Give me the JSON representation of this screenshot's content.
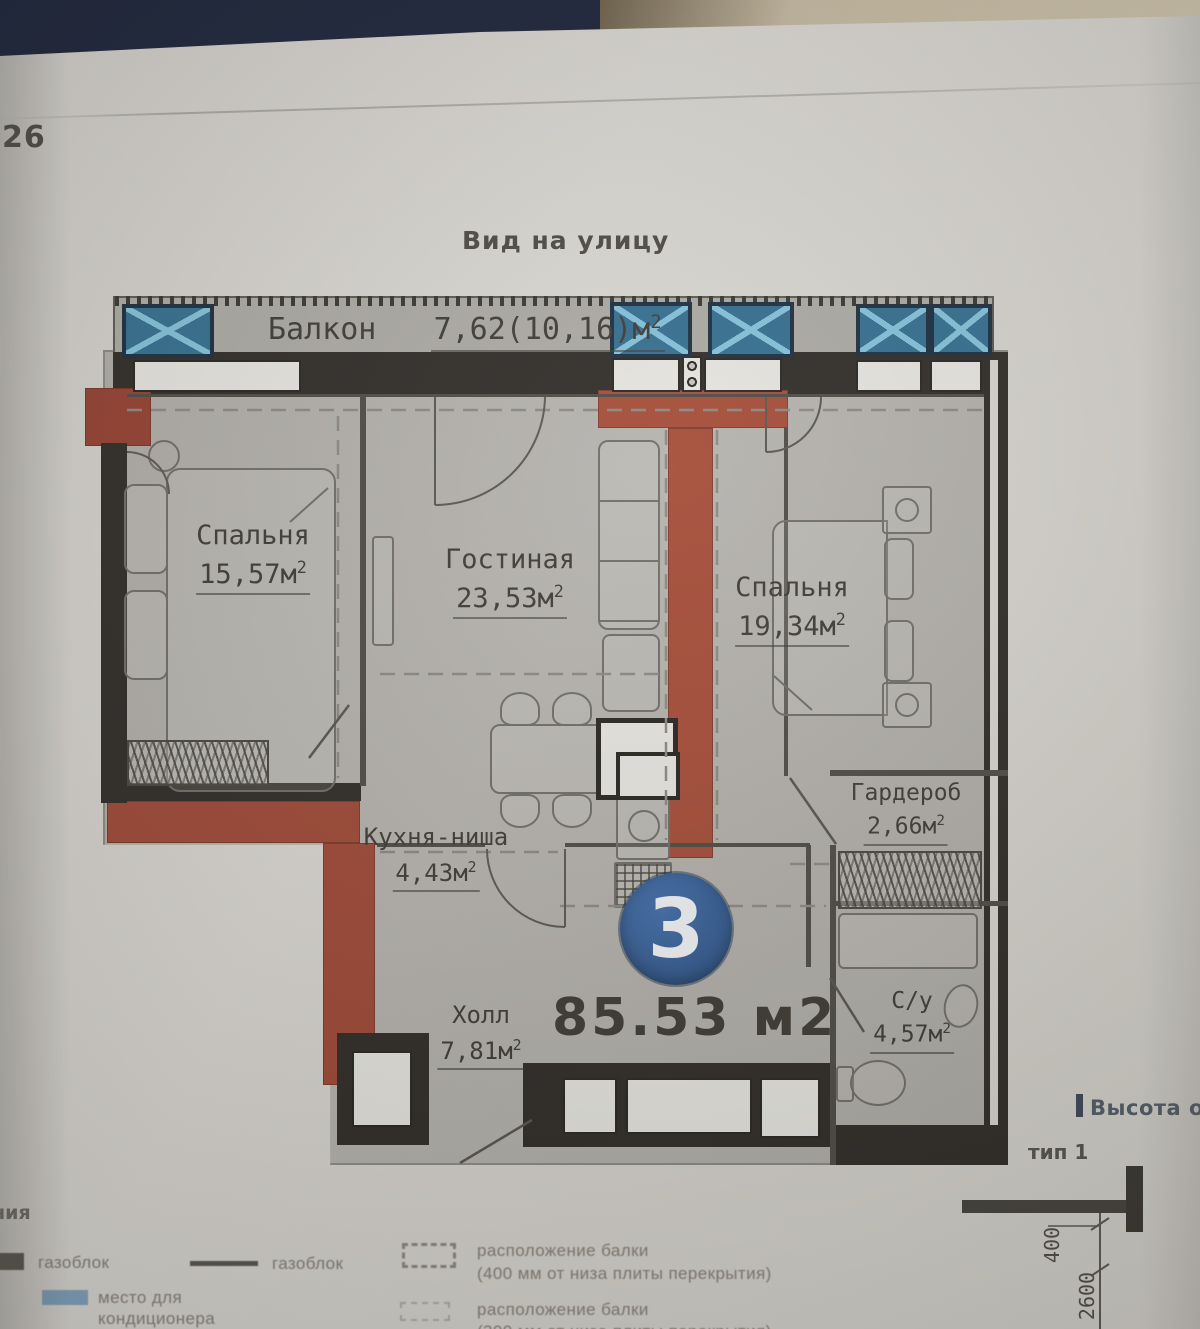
{
  "page": {
    "number": "26",
    "title": "Вид на улицу"
  },
  "plan": {
    "unit_number": "3",
    "total_area": "85.53 м2",
    "rooms": {
      "balcony": {
        "name": "Балкон",
        "area": "7,62(10,16)м",
        "sup": "2"
      },
      "bedroom1": {
        "name": "Спальня",
        "area": "15,57м",
        "sup": "2"
      },
      "living": {
        "name": "Гостиная",
        "area": "23,53м",
        "sup": "2"
      },
      "bedroom2": {
        "name": "Спальня",
        "area": "19,34м",
        "sup": "2"
      },
      "kitchen": {
        "name": "Кухня-ниша",
        "area": "4,43м",
        "sup": "2"
      },
      "hall": {
        "name": "Холл",
        "area": "7,81м",
        "sup": "2"
      },
      "wardrobe": {
        "name": "Гардероб",
        "area": "2,66м",
        "sup": "2"
      },
      "bathroom": {
        "name": "С/у",
        "area": "4,57м",
        "sup": "2"
      }
    }
  },
  "annotations": {
    "window_height": "Высота окон",
    "type": "тип 1",
    "dim_400": "400",
    "dim_2600": "2600",
    "left_edge_text": "ния"
  },
  "legend": {
    "items": [
      {
        "label": "газоблок"
      },
      {
        "label": "газоблок"
      },
      {
        "label_line1": "место для",
        "label_line2": "кондиционера"
      },
      {
        "label_line1": "расположение балки",
        "label_line2": "(400 мм от низа плиты перекрытия)"
      },
      {
        "label_line1": "расположение балки",
        "label_line2": "(300 мм от низа плиты перекрытия)"
      }
    ]
  },
  "colors": {
    "accent_red": "#a7432d",
    "unit_blue": "#2d5c9c",
    "ac_blue": "#2a6d93"
  }
}
